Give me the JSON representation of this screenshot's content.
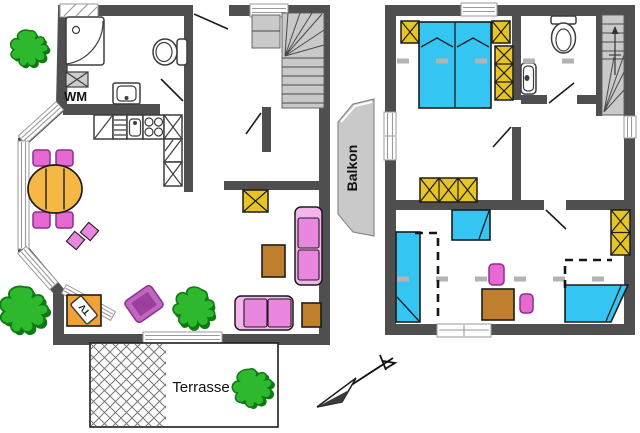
{
  "colors": {
    "wall": "#4f4f4f",
    "floor": "#ffffff",
    "window_frame": "#9a9a9a",
    "fixture": "#3d3d3d",
    "stair": "#c9c9c9",
    "outline": "#1c1c1c",
    "ink": "#111111",
    "bed_blue": "#35c5f2",
    "wardrobe_yellow": "#e6c423",
    "sofa_pink": "#f3b5ec",
    "cushion_pink": "#e887dd",
    "chair_magenta": "#e668d2",
    "chair_border": "#8d2d8d",
    "armchair_outer": "#c167c1",
    "armchair_inner": "#9d3f9d",
    "table_orange": "#f6b845",
    "wood_brown": "#c07f2e",
    "tv_orange": "#f0a237",
    "plant_green": "#2eb82e",
    "plant_dark": "#0e7a12",
    "balcony_gray": "#c9c9c9",
    "dash_gray": "#b3b3b3",
    "dash_black": "#151515",
    "hatch_gray": "#777777"
  },
  "labels": {
    "washing_machine": "WM",
    "tv": "TV",
    "terrace": "Terrasse",
    "balcony": "Balkon"
  },
  "plans": {
    "ground_floor": {
      "furniture": [
        "corner-shower",
        "toilet",
        "washing-machine",
        "washbasin",
        "kitchen-counter",
        "kitchen-sink",
        "stove",
        "staircase",
        "entrance-door",
        "dining-table",
        "dining-chairs",
        "seat-cushions",
        "tv-stand",
        "armchair",
        "two-seat-sofa-vertical",
        "two-seat-sofa-horizontal",
        "coffee-table",
        "side-table",
        "cabinet",
        "plants"
      ]
    },
    "upper_floor": {
      "furniture": [
        "double-bed",
        "nightstand-left",
        "nightstand-right",
        "wardrobe-tall",
        "wardrobe-wide",
        "wardrobe-small",
        "toilet",
        "washbasin",
        "staircase",
        "single-bed-left",
        "cot",
        "single-bed-right",
        "stool",
        "stool",
        "table"
      ]
    },
    "outdoor": {
      "areas": [
        "terrace",
        "balcony"
      ],
      "symbols": [
        "north-arrow",
        "plants"
      ]
    }
  }
}
